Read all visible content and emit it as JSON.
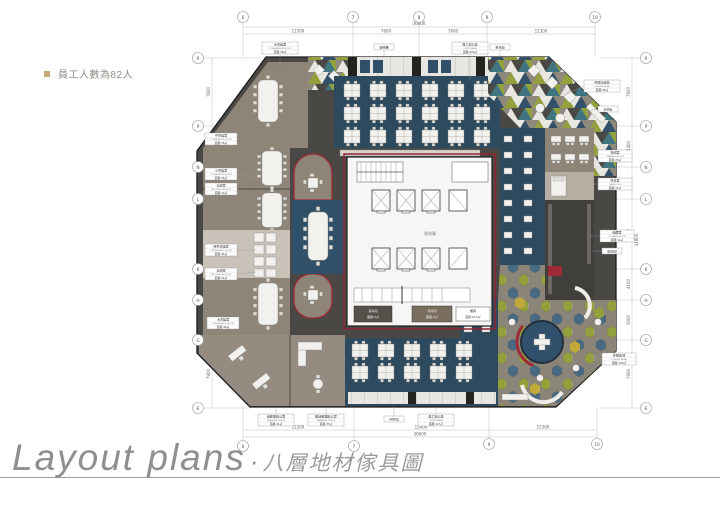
{
  "note": {
    "text": "員工人數為82人"
  },
  "title": {
    "en": "Layout plans",
    "dot": "·",
    "zh": "八層地材傢具圖"
  },
  "grid": {
    "top": [
      "6",
      "7",
      "8",
      "9",
      "10"
    ],
    "bottom": [
      "6",
      "7",
      "9",
      "10"
    ],
    "left": [
      "R",
      "P",
      "N",
      "L",
      "K",
      "H",
      "G",
      "E"
    ],
    "right": [
      "R",
      "P",
      "N",
      "L",
      "K",
      "H",
      "G",
      "E"
    ]
  },
  "dims": {
    "top_total": "36600",
    "top": [
      "12300",
      "7600",
      "7600",
      "12300"
    ],
    "bottom": [
      "12200",
      "15000",
      "12300"
    ],
    "bottom_total": "36600",
    "left": [
      "7600",
      "3000",
      "3600",
      "3000",
      "3000",
      "4400",
      "7900"
    ],
    "right": [
      "7600",
      "4400",
      "3600",
      "3000",
      "4100",
      "3000",
      "7900"
    ],
    "side_total": "34800"
  },
  "labels": {
    "conf_tl": {
      "zh": "大會議室",
      "en": "CONFERENCE ROOM",
      "area": "面積:36㎡"
    },
    "office_top": {
      "zh": "員工辦公區",
      "en": "OFFICE AREA",
      "area": "面積:240㎡"
    },
    "lockers": {
      "text": "儲物櫃"
    },
    "pantry_top": {
      "text": "茶水間"
    },
    "leisure_tr": {
      "zh": "休閒洽談區",
      "en": "LEISURE AREA",
      "area": "面積:95㎡"
    },
    "bar": {
      "text": "水吧台"
    },
    "training": {
      "zh": "培訓室",
      "en": "TRAINING ROOM",
      "area": "面積:27㎡"
    },
    "bedroom": {
      "zh": "休息室",
      "en": "BEDROOM",
      "area": "面積:15㎡"
    },
    "storage": {
      "zh": "儲藏室",
      "en": "STORAGE ROOM",
      "area": "面積:11㎡"
    },
    "water": {
      "text": "開水間"
    },
    "leisure_br": {
      "zh": "休閒區域",
      "en": "LEISURE AREA",
      "area": "面積:130㎡"
    },
    "manager1": {
      "zh": "總經理辦公室",
      "en": "MANAGER OFFICE",
      "area": "面積:41㎡"
    },
    "manager2": {
      "zh": "副總經理辦公室",
      "en": "MANAGER OFFICE",
      "area": "面積:37㎡"
    },
    "seats": {
      "text": "共88位"
    },
    "office_bottom": {
      "zh": "員工辦公區",
      "en": "OFFICE AREA",
      "area": "面積:117㎡"
    },
    "conf_l1": {
      "zh": "中會議室",
      "en": "CONFERENCE ROOM",
      "area": "面積:15㎡"
    },
    "conf_l2": {
      "zh": "小會議室",
      "en": "CONFERENCE ROOM",
      "area": "面積:15㎡"
    },
    "conf_l3": {
      "zh": "洽談室",
      "en": "DISCUSSION ROOM",
      "area": "面積:12㎡"
    },
    "conf_l4": {
      "zh": "特色會議室",
      "en": "CONFERENCE ROOM",
      "area": "面積:41㎡"
    },
    "conf_l5": {
      "zh": "洽談室",
      "en": "DISCUSSION ROOM",
      "area": "面積:12㎡"
    },
    "conf_l6": {
      "zh": "大會議室",
      "en": "CONFERENCE ROOM",
      "area": "面積:44㎡"
    }
  },
  "core": {
    "lobby": "電梯廳",
    "pantry": {
      "zh": "茶水間",
      "en": "PANTRY ROOM",
      "area": "面積:9㎡"
    },
    "clean": {
      "zh": "清潔間",
      "en": "CLEAN ROOM",
      "area": "面積:9㎡"
    },
    "master": {
      "zh": "機房",
      "en": "MASTER ROOM",
      "area": "面積:11.5㎡"
    }
  },
  "colors": {
    "accent_red": "#9e2a36",
    "carpet_blue": "#2e4a5f",
    "floor_taupe": "#8e8478",
    "circulation": "#4a4845",
    "olive": "#93a13d",
    "teal": "#3f7580",
    "mustard": "#c3a93c"
  }
}
